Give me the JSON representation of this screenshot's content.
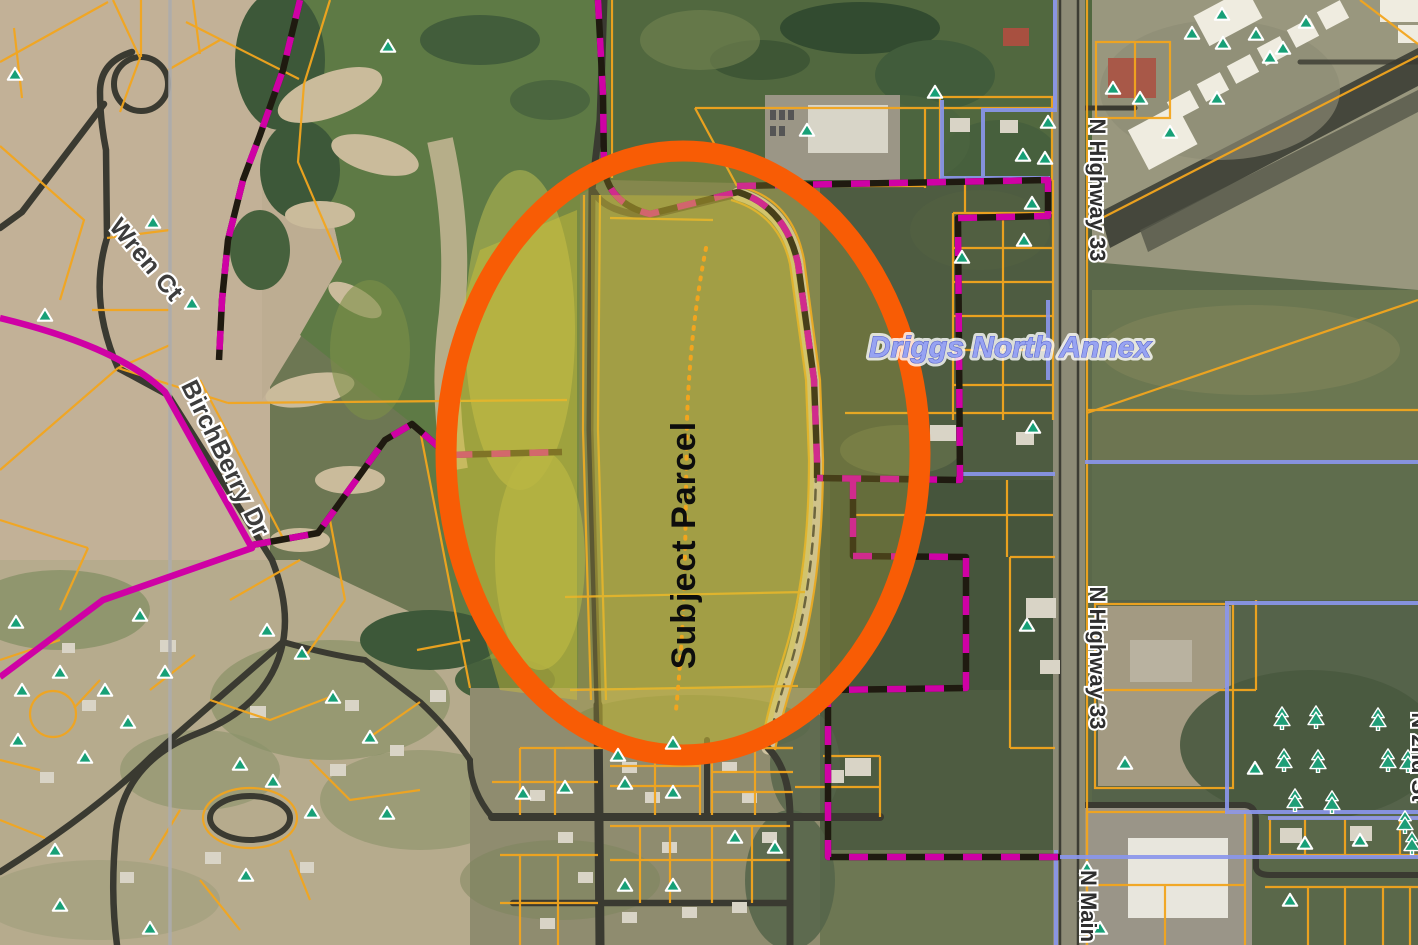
{
  "map": {
    "annotation": {
      "subject_parcel": "Subject Parcel"
    },
    "street_labels": {
      "wren_ct": "Wren Ct",
      "birchberry_dr": "BirchBerry Dr",
      "n_highway_33_north": "N Highway 33",
      "n_highway_33_south": "N Highway 33",
      "n_main": "N Main",
      "n_2nd_st": "N 2nd St"
    },
    "area_labels": {
      "driggs_north_annex": "Driggs North Annex"
    },
    "colors": {
      "highlight_ellipse": "#f85c05",
      "parcel_lines": "#f2a51e",
      "city_boundary_magenta": "#cf01a5",
      "city_boundary_black": "#1f1a10",
      "annexation_blue": "#8a96ea",
      "section_line_gray": "#acacac",
      "site_marker_green": "#17a077",
      "tree_marker_green": "#1f9e77",
      "subject_parcel_fill": "#d6c63a",
      "road_dark": "#3a3a31",
      "annex_label_blue": "#97a3f2"
    },
    "markers": {
      "site_marker_icon": "green-triangle",
      "tree_marker_icon": "green-pine-cluster"
    }
  }
}
